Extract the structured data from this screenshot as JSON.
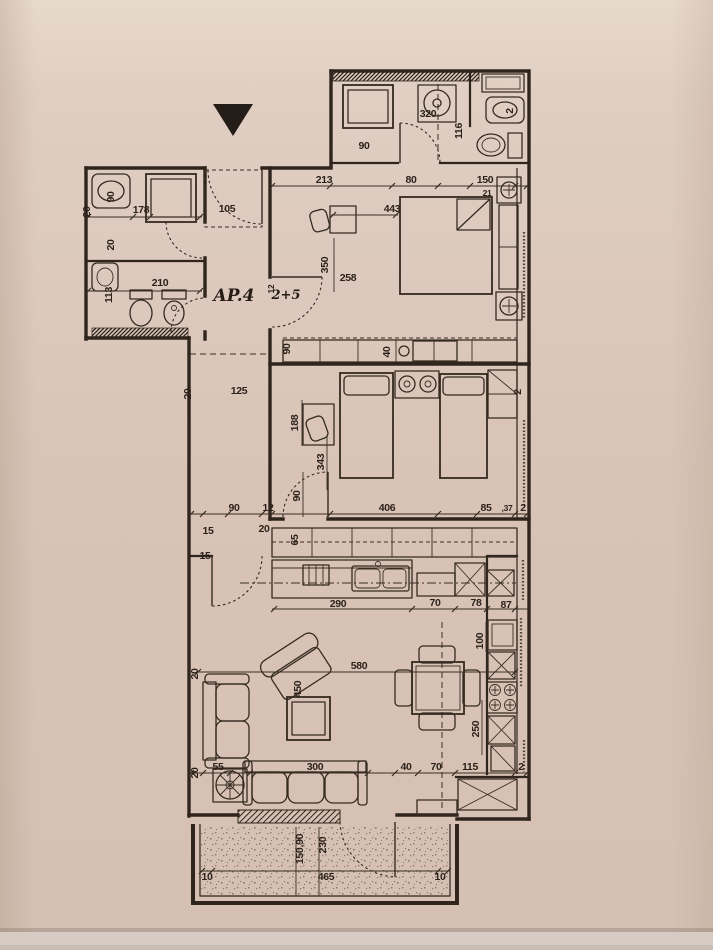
{
  "colors": {
    "paper": "#d9c3b7",
    "ink": "#2f251d"
  },
  "labels": [
    "90",
    "320",
    "116",
    "2",
    "213",
    "80",
    "150",
    "21",
    "443",
    "178",
    "105",
    "20",
    "90",
    "20",
    "350",
    "258",
    "113",
    "210",
    "AP.4",
    "2+5",
    "12",
    "90",
    "40",
    "2",
    "125",
    "20",
    "188",
    "343",
    "90",
    "12",
    "90",
    "406",
    "85",
    ",37",
    "2",
    "15",
    "20",
    "65",
    "15",
    "290",
    "70",
    "78",
    "87",
    "100",
    "580",
    "450",
    "20",
    "250",
    "115",
    "2",
    "20",
    "55",
    "300",
    "40",
    "70",
    "150,90",
    "230",
    "10",
    "465",
    "10"
  ]
}
